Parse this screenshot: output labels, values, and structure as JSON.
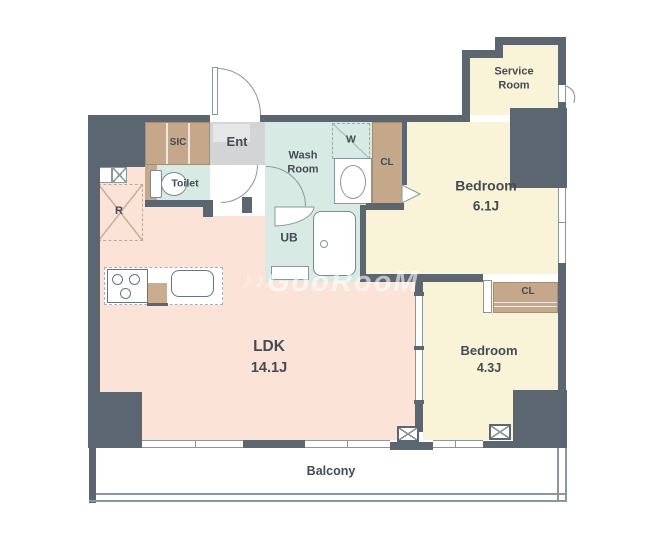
{
  "theme": {
    "wall": "#5b6670",
    "ldk_floor": "#fce3d7",
    "bedroom_floor": "#f9f3d8",
    "wet_floor": "#d8eae4",
    "closet_fill": "#c5a88a",
    "ent_floor": "#d2d4d6",
    "ent_inner": "#e4e6e7",
    "line": "#8b959c",
    "text": "#454b54"
  },
  "rooms": {
    "ldk": {
      "label": "LDK",
      "size": "14.1J"
    },
    "bedroom_main": {
      "label": "Bedroom",
      "size": "6.1J"
    },
    "bedroom_second": {
      "label": "Bedroom",
      "size": "4.3J"
    },
    "service_room": {
      "label": "Service Room"
    },
    "wash_room": {
      "label": "Wash Room"
    },
    "toilet": {
      "label": "Toilet"
    },
    "bath": {
      "label": "UB"
    },
    "entrance": {
      "label": "Ent"
    },
    "shoe_closet": {
      "label": "SIC"
    },
    "washer_space": {
      "label": "W"
    },
    "closet_main": {
      "label": "CL"
    },
    "closet_second": {
      "label": "CL"
    },
    "refrigerator_space": {
      "label": "R"
    },
    "balcony": {
      "label": "Balcony"
    }
  },
  "watermark": {
    "prefix": "♪♪",
    "text": "GooRooM"
  }
}
